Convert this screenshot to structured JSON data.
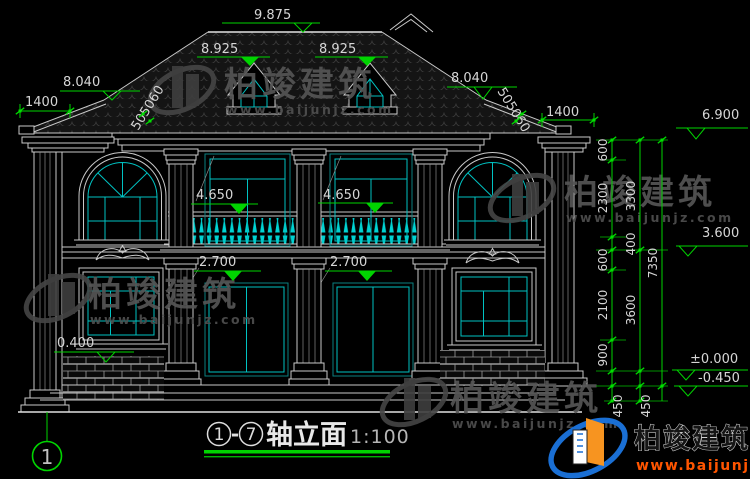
{
  "drawing": {
    "markers": {
      "ridge": "9.875",
      "dormer_left": "8.925",
      "dormer_right": "8.925",
      "wing_left": "8.040",
      "wing_right": "8.040",
      "eave": "6.900",
      "floor2": "3.600",
      "balcony_left": "4.650",
      "balcony_right": "4.650",
      "door_left": "2.700",
      "door_right": "2.700",
      "sill_left": "0.400",
      "ground": "±0.000",
      "grade": "-0.450"
    },
    "top_dims": {
      "overhang_left": "1400",
      "overhang_right": "1400",
      "slope_left": "505060",
      "slope_right": "505060"
    },
    "chain": {
      "c1": [
        "600",
        "2300",
        "400",
        "600",
        "2100",
        "900"
      ],
      "c2": [
        "3300",
        "3600"
      ],
      "c3": [
        "7350"
      ],
      "base": [
        "450",
        "450"
      ]
    },
    "axis": {
      "start": "1",
      "end": "7",
      "bubble": "1"
    },
    "title": {
      "dash": "-",
      "name": "轴立面",
      "scale": "1:100"
    },
    "watermark": {
      "brand": "柏竣建筑",
      "url": "www.baijunjz.com"
    },
    "logo": {
      "brand": "柏竣建筑",
      "url": "www.baijunjz.com"
    }
  }
}
